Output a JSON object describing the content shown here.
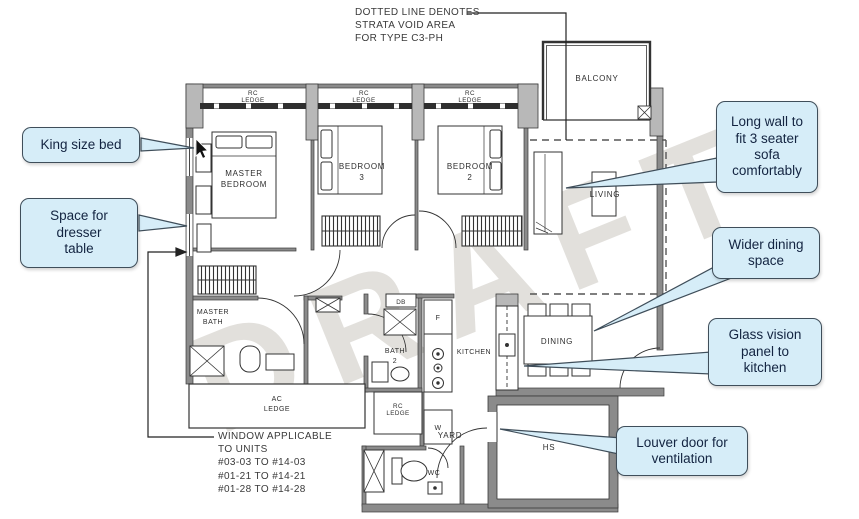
{
  "watermark": "DRAFT",
  "colors": {
    "callout_fill": "#d6edf8",
    "callout_border": "#3f4e5a",
    "callout_text": "#132441",
    "wall_fill": "#8b8b8b",
    "column_fill": "#b8b8b8",
    "line": "#333333",
    "watermark_color": "#ada69c"
  },
  "annotations": {
    "strata_note": [
      "DOTTED LINE DENOTES",
      "STRATA VOID AREA",
      "FOR TYPE C3-PH"
    ],
    "window_note": [
      "WINDOW APPLICABLE",
      "TO UNITS",
      "#03-03 TO #14-03",
      "#01-21 TO #14-21",
      "#01-28 TO #14-28"
    ]
  },
  "callouts": {
    "king_bed": [
      "King size bed"
    ],
    "dresser": [
      "Space for",
      "dresser",
      "table"
    ],
    "sofa": [
      "Long wall to",
      "fit 3 seater",
      "sofa",
      "comfortably"
    ],
    "dining": [
      "Wider dining",
      "space"
    ],
    "glass_panel": [
      "Glass vision",
      "panel to",
      "kitchen"
    ],
    "louver_door": [
      "Louver door for",
      "ventilation"
    ]
  },
  "rooms": {
    "master_bedroom": [
      "MASTER",
      "BEDROOM"
    ],
    "bedroom3": [
      "BEDROOM",
      "3"
    ],
    "bedroom2": [
      "BEDROOM",
      "2"
    ],
    "living": "LIVING",
    "balcony": "BALCONY",
    "master_bath": [
      "MASTER",
      "BATH"
    ],
    "bath2": [
      "BATH",
      "2"
    ],
    "kitchen": "KITCHEN",
    "dining": "DINING",
    "yard": "YARD",
    "wc": "WC",
    "hs": "HS",
    "db": "DB",
    "fridge": "F",
    "washer": "W",
    "ac_ledge": [
      "AC",
      "LEDGE"
    ],
    "rc_ledge": [
      "RC",
      "LEDGE"
    ]
  }
}
